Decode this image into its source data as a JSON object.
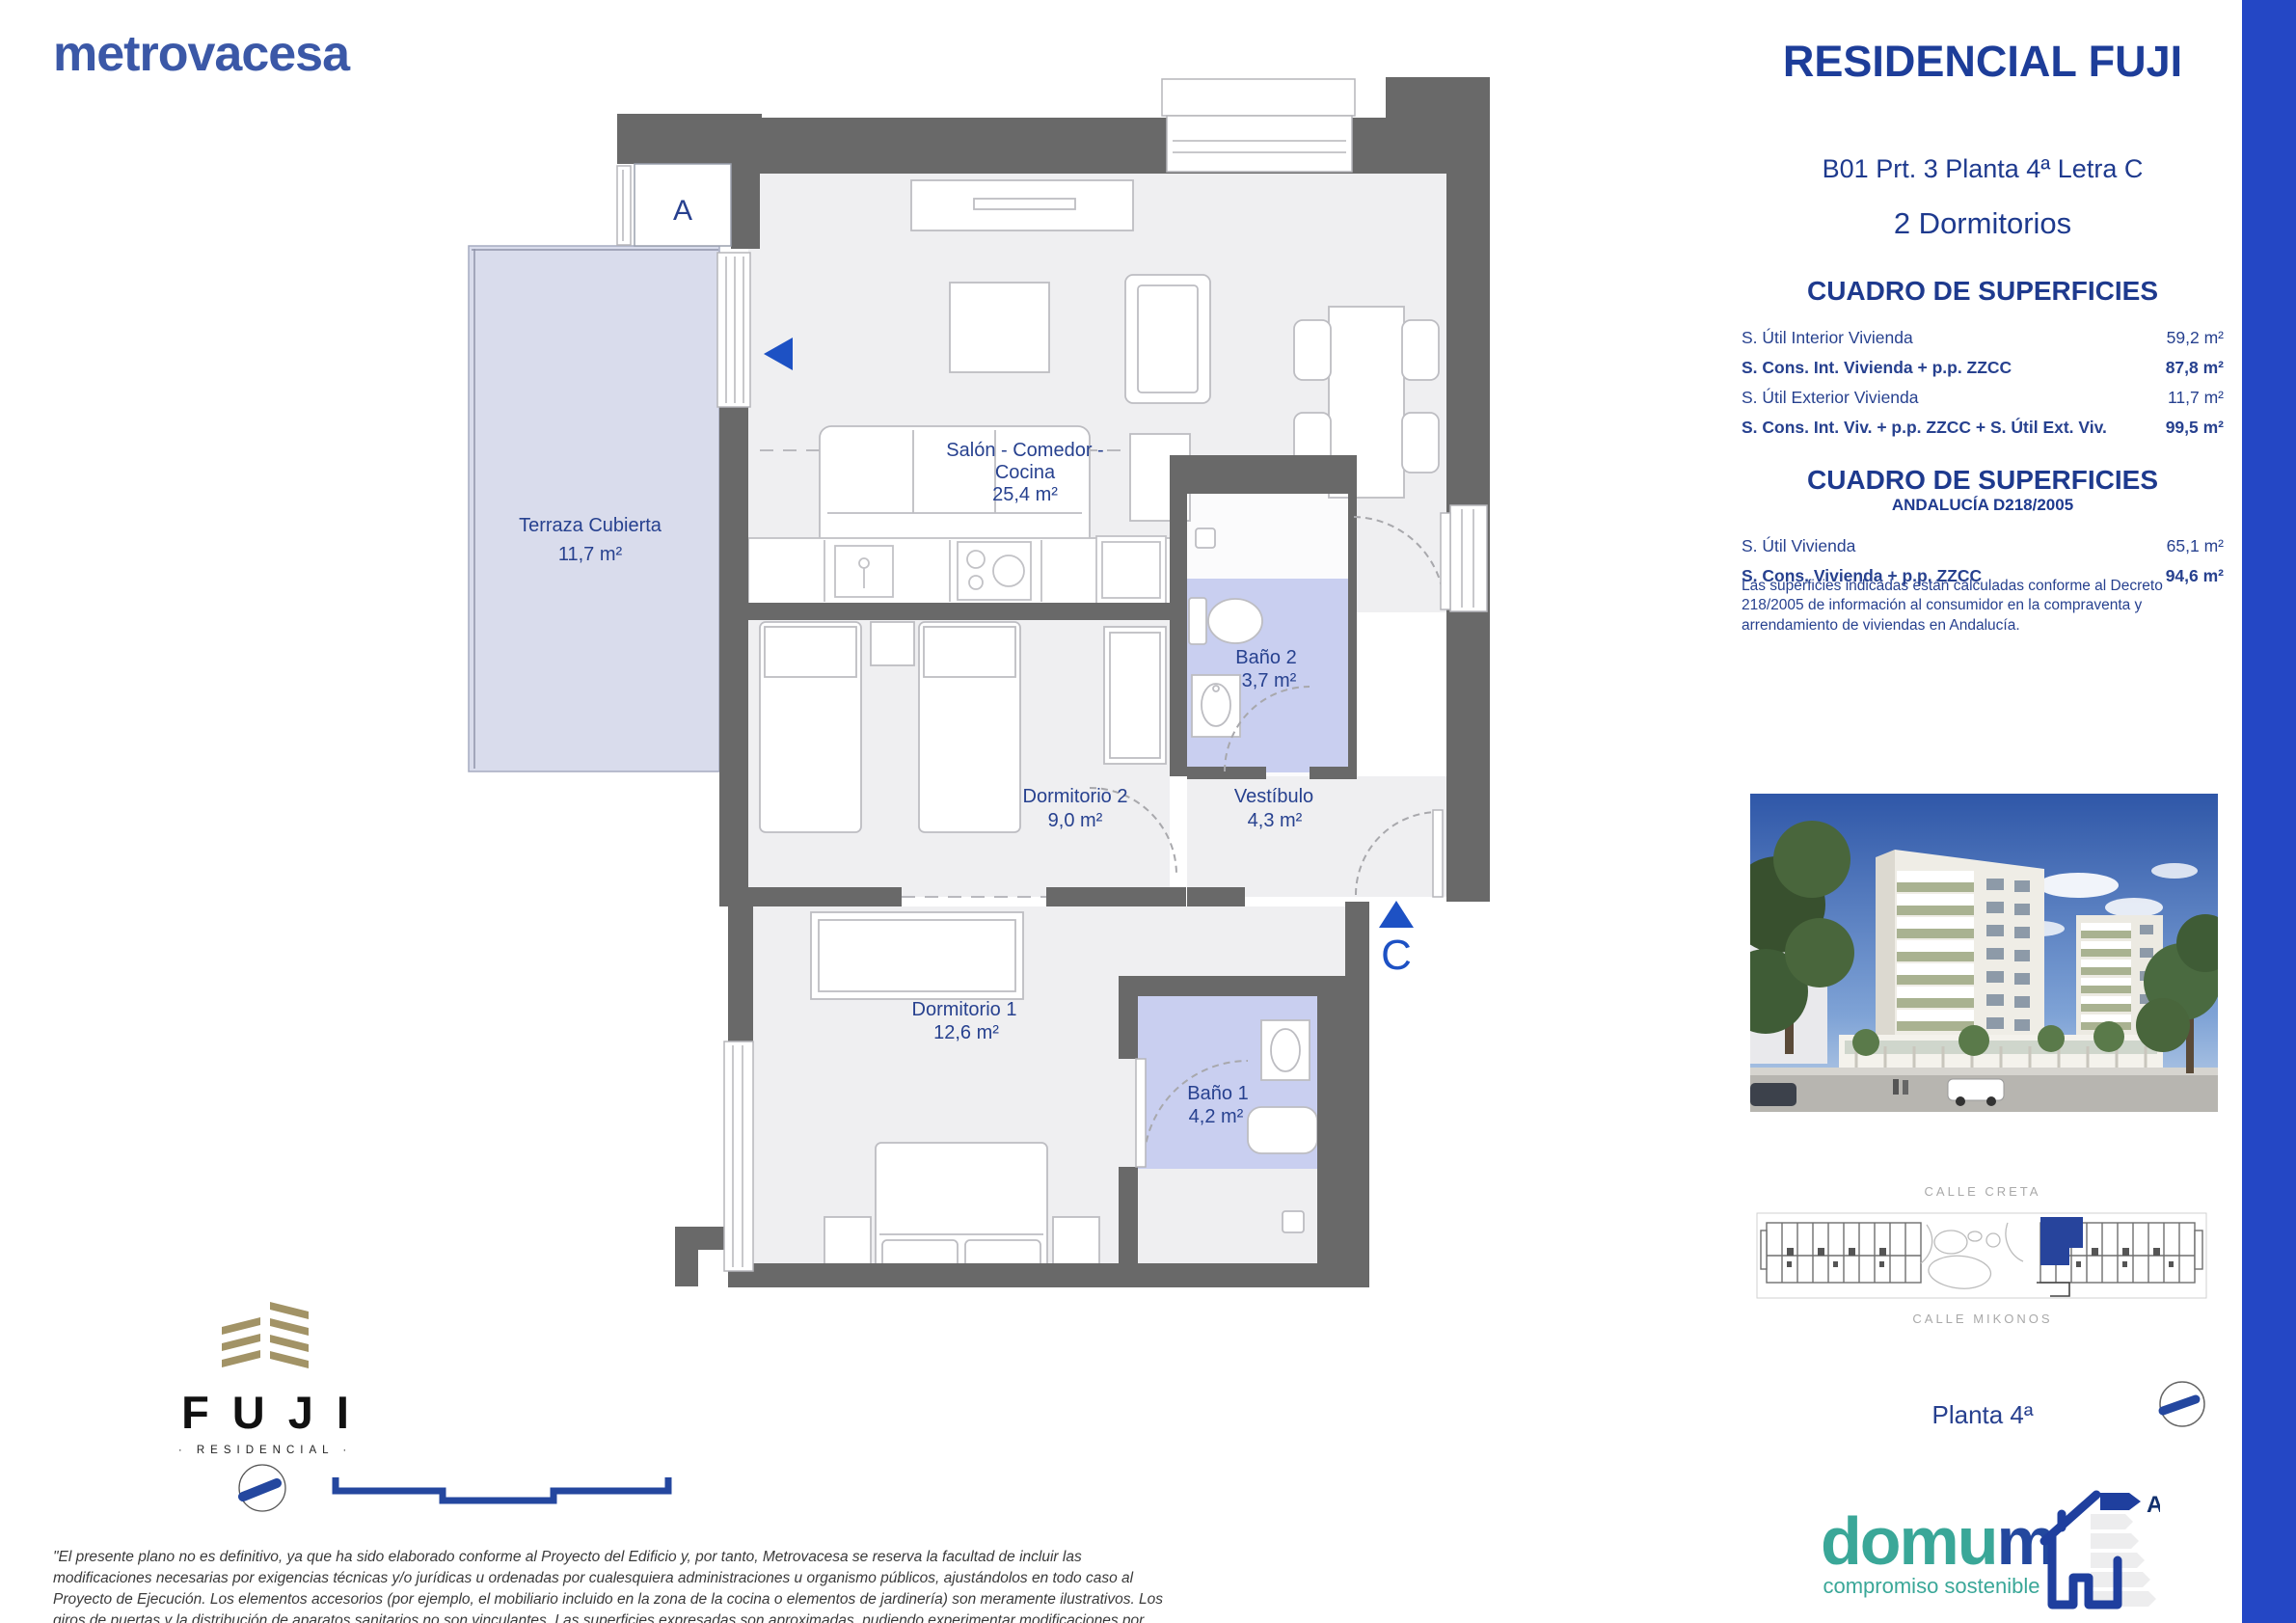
{
  "brand": {
    "name": "metrovacesa"
  },
  "header": {
    "title": "RESIDENCIAL FUJI",
    "unit": "B01 Prt. 3 Planta 4ª Letra C",
    "type": "2 Dormitorios"
  },
  "surfaces": {
    "title": "CUADRO DE SUPERFICIES",
    "rows": [
      {
        "label": "S. Útil Interior Vivienda",
        "value": "59,2 m²"
      },
      {
        "label": "S. Cons. Int. Vivienda + p.p. ZZCC",
        "value": "87,8 m²"
      },
      {
        "label": "S. Útil Exterior Vivienda",
        "value": "11,7 m²"
      },
      {
        "label": "S. Cons. Int. Viv. + p.p. ZZCC + S. Útil Ext. Viv.",
        "value": "99,5 m²"
      }
    ]
  },
  "surfaces_andalucia": {
    "title": "CUADRO DE SUPERFICIES",
    "subtitle": "ANDALUCÍA D218/2005",
    "rows": [
      {
        "label": "S. Útil Vivienda",
        "value": "65,1 m²"
      },
      {
        "label": "S. Cons. Vivienda + p.p. ZZCC",
        "value": "94,6 m²"
      }
    ],
    "note": "Las superficies indicadas están calculadas conforme al Decreto 218/2005 de información al consumidor en la compraventa y arrendamiento de viviendas en Andalucía."
  },
  "floorplan": {
    "portal_marker": "A",
    "entrance_marker": "C",
    "rooms": {
      "terraza": {
        "name": "Terraza Cubierta",
        "area": "11,7 m²"
      },
      "salon": {
        "name_line1": "Salón - Comedor -",
        "name_line2": "Cocina",
        "area": "25,4 m²"
      },
      "bano2": {
        "name": "Baño 2",
        "area": "3,7 m²"
      },
      "dormitorio2": {
        "name": "Dormitorio 2",
        "area": "9,0 m²"
      },
      "vestibulo": {
        "name": "Vestíbulo",
        "area": "4,3 m²"
      },
      "dormitorio1": {
        "name": "Dormitorio 1",
        "area": "12,6 m²"
      },
      "bano1": {
        "name": "Baño 1",
        "area": "4,2 m²"
      }
    }
  },
  "siteplan": {
    "street_top": "CALLE CRETA",
    "street_bottom": "CALLE MIKONOS"
  },
  "floor_label": "Planta 4ª",
  "project_logo": {
    "name": "FUJI",
    "tagline": "· RESIDENCIAL ·"
  },
  "domum": {
    "word_teal": "domu",
    "word_blue": "m",
    "tagline": "compromiso sostenible",
    "energy_letter": "A"
  },
  "disclaimer": "\"El presente plano no es definitivo, ya que ha sido elaborado conforme al Proyecto del Edificio y, por tanto, Metrovacesa se reserva la facultad de incluir las modificaciones necesarias por exigencias técnicas y/o jurídicas u ordenadas por cualesquiera administraciones u organismo públicos, ajustándolos en todo caso al Proyecto de Ejecución. Los elementos accesorios (por ejemplo, el mobiliario incluido en la zona de la cocina o elementos de jardinería) son meramente ilustrativos. Los giros de puertas y la distribución de aparatos sanitarios no son vinculantes. Las superficies expresadas son aproximadas, pudiendo experimentar modificaciones por razones de índole técnico y/o legal en el desarrollo de la ejecución de las obras. Las superficies útiles de terrazas reflejadas en plano son reales, computan en la superficie útil total de VP (Calificación Provisional) según normativa vigente. La clasificación final de los sellos de sostenibilidad se obtendrán tras el desarrollo del Proyecto de Ejecución.\"",
  "colors": {
    "accent_blue": "#2447c5",
    "navy": "#1d3d99",
    "plan_label_blue": "#27418f",
    "marker_blue": "#1d51c4",
    "teal": "#3aa798",
    "gold": "#a29366",
    "wall_gray": "#696969",
    "room_gray": "#efeff1",
    "terrace_lavender": "#d9dcec",
    "bath_lavender": "#c9cff0"
  }
}
